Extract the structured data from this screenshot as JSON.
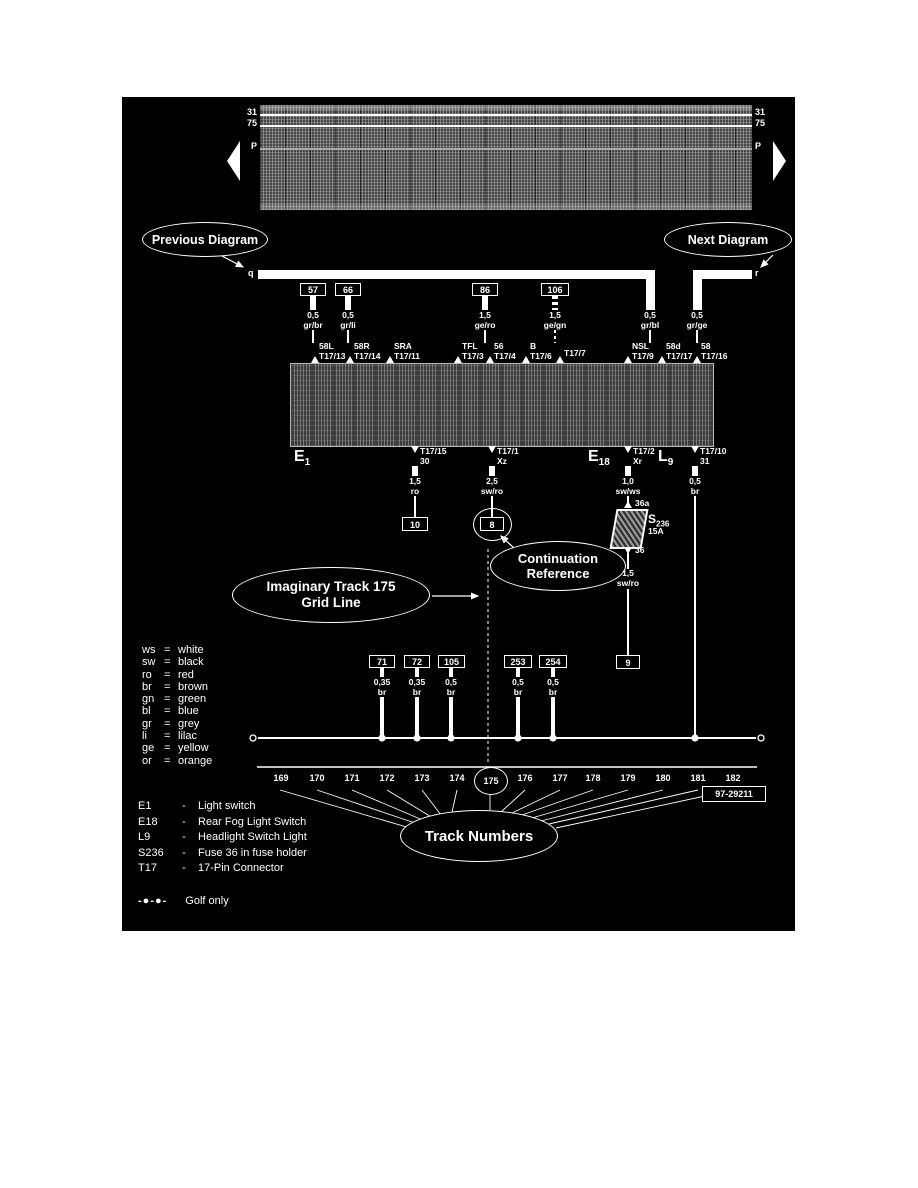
{
  "colors": {
    "page": "#ffffff",
    "panel_bg": "#000000",
    "fg": "#ffffff"
  },
  "overview": {
    "left_labels": [
      "31",
      "75",
      "P"
    ],
    "right_labels": [
      "31",
      "75",
      "P"
    ]
  },
  "callouts": {
    "previous": "Previous Diagram",
    "next": "Next Diagram",
    "continuation_line1": "Continuation",
    "continuation_line2": "Reference",
    "imaginary_line1": "Imaginary Track 175",
    "imaginary_line2": "Grid Line",
    "tracks": "Track Numbers"
  },
  "bus": {
    "left_letter": "q",
    "right_letter": "r"
  },
  "top_wires": [
    {
      "ref": "57",
      "gauge": "0,5",
      "color": "gr/br"
    },
    {
      "ref": "66",
      "gauge": "0,5",
      "color": "gr/li"
    },
    {
      "ref": "86",
      "gauge": "1,5",
      "color": "ge/ro"
    },
    {
      "ref": "106",
      "gauge": "1,5",
      "color": "ge/gn"
    }
  ],
  "feed_wires": [
    {
      "gauge": "0,5",
      "color": "gr/bl"
    },
    {
      "gauge": "0,5",
      "color": "gr/ge"
    }
  ],
  "top_pins": [
    {
      "name": "58L",
      "pin": "T17/13"
    },
    {
      "name": "58R",
      "pin": "T17/14"
    },
    {
      "name": "SRA",
      "pin": "T17/11"
    },
    {
      "name": "TFL",
      "pin": "T17/3"
    },
    {
      "name": "56",
      "pin": "T17/4"
    },
    {
      "name": "B",
      "pin": "T17/6"
    },
    {
      "name": "",
      "pin": "T17/7"
    },
    {
      "name": "NSL",
      "pin": "T17/9"
    },
    {
      "name": "58d",
      "pin": "T17/17"
    },
    {
      "name": "58",
      "pin": "T17/16"
    }
  ],
  "components": {
    "e1": {
      "main": "E",
      "sub": "1"
    },
    "e18": {
      "main": "E",
      "sub": "18"
    },
    "l9": {
      "main": "L",
      "sub": "9"
    },
    "s236": {
      "main": "S",
      "sub": "236",
      "rating": "15A",
      "pin_top": "36a",
      "pin_bottom": "36"
    }
  },
  "bottom_pins": [
    {
      "pin": "T17/15",
      "terminal": "30"
    },
    {
      "pin": "T17/1",
      "terminal": "Xz"
    },
    {
      "pin": "T17/2",
      "terminal": "Xr"
    },
    {
      "pin": "T17/10",
      "terminal": "31"
    }
  ],
  "down_wires": [
    {
      "gauge": "1,5",
      "color": "ro",
      "ref": "10"
    },
    {
      "gauge": "2,5",
      "color": "sw/ro",
      "ref": "8"
    },
    {
      "gauge": "1,0",
      "color": "sw/ws"
    },
    {
      "gauge": "0,5",
      "color": "br"
    }
  ],
  "fuse_out": {
    "gauge": "1,5",
    "color": "sw/ro",
    "ref": "9"
  },
  "ground_wires": [
    {
      "ref": "71",
      "gauge": "0,35",
      "color": "br"
    },
    {
      "ref": "72",
      "gauge": "0,35",
      "color": "br"
    },
    {
      "ref": "105",
      "gauge": "0,5",
      "color": "br"
    },
    {
      "ref": "253",
      "gauge": "0,5",
      "color": "br"
    },
    {
      "ref": "254",
      "gauge": "0,5",
      "color": "br"
    }
  ],
  "color_legend": [
    {
      "code": "ws",
      "eq": "=",
      "name": "white"
    },
    {
      "code": "sw",
      "eq": "=",
      "name": "black"
    },
    {
      "code": "ro",
      "eq": "=",
      "name": "red"
    },
    {
      "code": "br",
      "eq": "=",
      "name": "brown"
    },
    {
      "code": "gn",
      "eq": "=",
      "name": "green"
    },
    {
      "code": "bl",
      "eq": "=",
      "name": "blue"
    },
    {
      "code": "gr",
      "eq": "=",
      "name": "grey"
    },
    {
      "code": "li",
      "eq": "=",
      "name": "lilac"
    },
    {
      "code": "ge",
      "eq": "=",
      "name": "yellow"
    },
    {
      "code": "or",
      "eq": "=",
      "name": "orange"
    }
  ],
  "tracks": {
    "numbers": [
      "169",
      "170",
      "171",
      "172",
      "173",
      "174",
      "175",
      "176",
      "177",
      "178",
      "179",
      "180",
      "181",
      "182"
    ],
    "highlighted": "175",
    "doc_number": "97-29211"
  },
  "component_legend": [
    {
      "code": "E1",
      "dash": "-",
      "desc": "Light switch"
    },
    {
      "code": "E18",
      "dash": "-",
      "desc": "Rear Fog Light Switch"
    },
    {
      "code": "L9",
      "dash": "-",
      "desc": "Headlight Switch Light"
    },
    {
      "code": "S236",
      "dash": "-",
      "desc": "Fuse 36 in fuse holder"
    },
    {
      "code": "T17",
      "dash": "-",
      "desc": "17-Pin Connector"
    }
  ],
  "golf_only": {
    "swatch": "-●-●-",
    "label": "Golf only"
  }
}
